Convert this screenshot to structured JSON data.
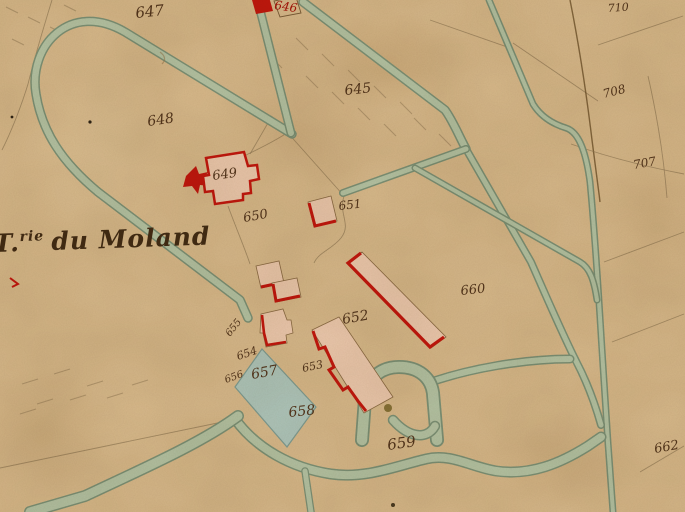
{
  "map": {
    "kind": "historical-cadastral-map",
    "title": {
      "initial": "T",
      "dot": ".",
      "superscript": "rie",
      "name": "du Moland"
    },
    "parcel_labels": [
      {
        "id": "647",
        "text": "647"
      },
      {
        "id": "646",
        "text": "646"
      },
      {
        "id": "645",
        "text": "645"
      },
      {
        "id": "648",
        "text": "648"
      },
      {
        "id": "649",
        "text": "649"
      },
      {
        "id": "650",
        "text": "650"
      },
      {
        "id": "651",
        "text": "651"
      },
      {
        "id": "652",
        "text": "652"
      },
      {
        "id": "653",
        "text": "653"
      },
      {
        "id": "654",
        "text": "654"
      },
      {
        "id": "655",
        "text": "655"
      },
      {
        "id": "656",
        "text": "656"
      },
      {
        "id": "657",
        "text": "657"
      },
      {
        "id": "658",
        "text": "658"
      },
      {
        "id": "659",
        "text": "659"
      },
      {
        "id": "660",
        "text": "660"
      },
      {
        "id": "662",
        "text": "662"
      },
      {
        "id": "710",
        "text": "710"
      },
      {
        "id": "708",
        "text": "708"
      },
      {
        "id": "707",
        "text": "707"
      }
    ],
    "colors": {
      "paper": "#d7b98b",
      "road_fill": "#b4c3a4",
      "road_edge": "#7c9176",
      "courtyard_water": "#aec5bb",
      "building_fill": "#ecc9ae",
      "building_red": "#c2170c",
      "ink": "#53351b",
      "red_ink": "#a51408",
      "pencil": "#8b7350"
    }
  }
}
